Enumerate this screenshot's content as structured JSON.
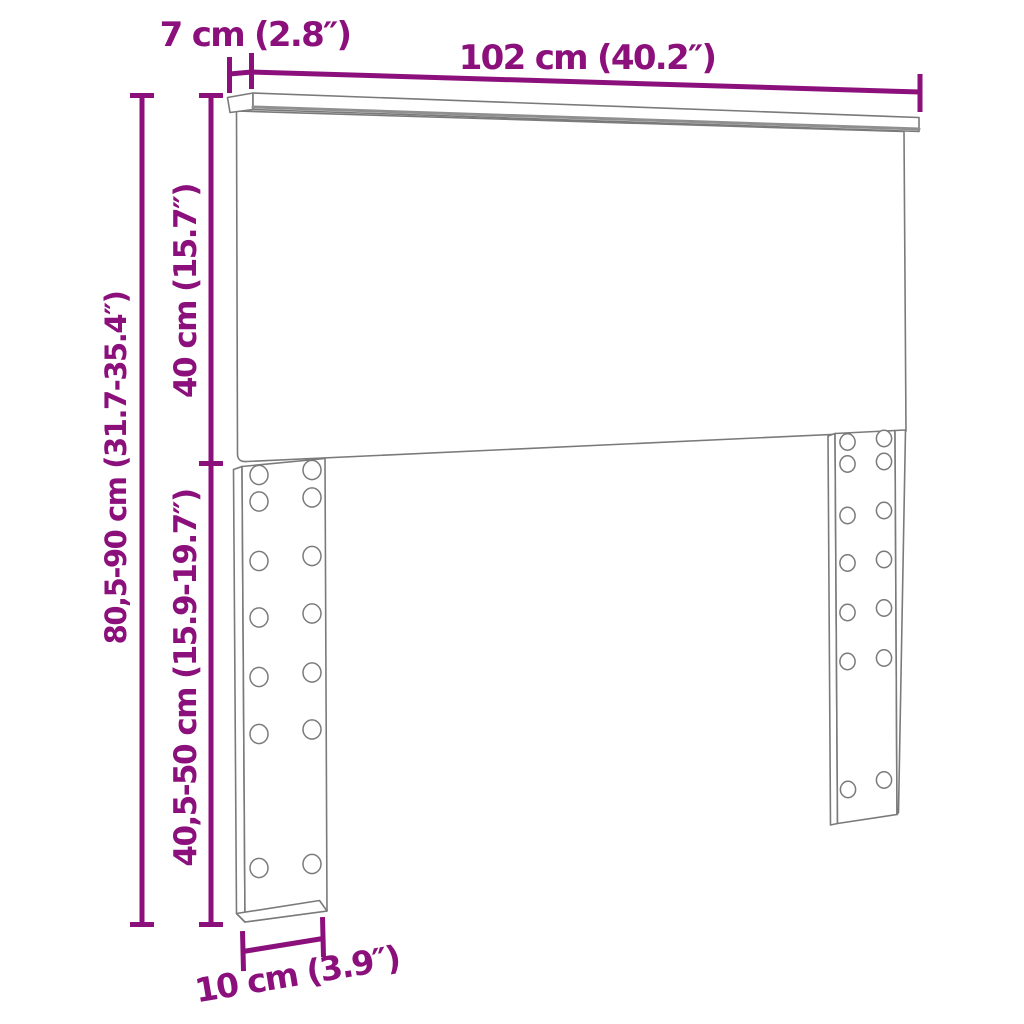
{
  "diagram": {
    "title": "Headboard dimension diagram",
    "product": "headboard with two slotted legs",
    "colors": {
      "dimension_annotation": "#8B107C",
      "product_outline": "#7A7A7A",
      "background": "#FFFFFF"
    },
    "legs": {
      "count": 2,
      "hole_columns_per_leg": 2,
      "hole_rows_per_leg": 7
    },
    "labels": {
      "top_rail_depth": "7 cm (2.8″)",
      "width": "102 cm (40.2″)",
      "overall_height": "80,5-90 cm (31.7-35.4″)",
      "panel_height": "40 cm (15.7″)",
      "leg_section_height": "40,5-50 cm (15.9-19.7″)",
      "leg_width": "10 cm (3.9″)"
    }
  }
}
